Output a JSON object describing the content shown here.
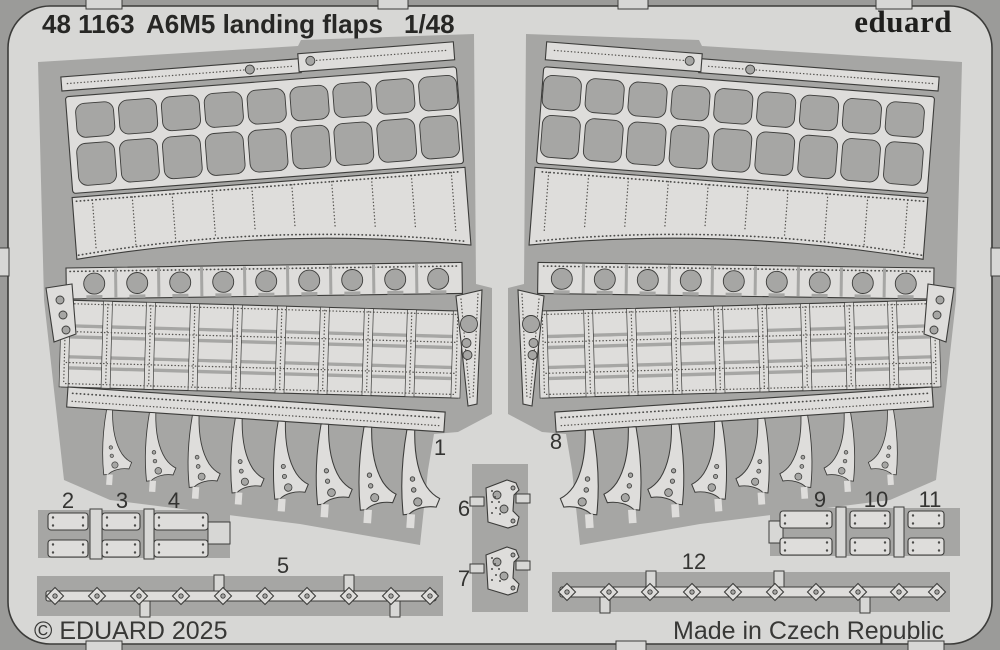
{
  "header": {
    "catalog_number": "48 1163",
    "title": "A6M5 landing flaps",
    "scale": "1/48",
    "brand": "eduard"
  },
  "footer": {
    "copyright": "© EDUARD 2025",
    "made_in": "Made in Czech Republic"
  },
  "part_labels": {
    "l1": "1",
    "l2": "2",
    "l3": "3",
    "l4": "4",
    "l5": "5",
    "l6": "6",
    "l7": "7",
    "l8": "8",
    "l9": "9",
    "l10": "10",
    "l11": "11",
    "l12": "12"
  },
  "colors": {
    "background": "#9b9b99",
    "fret_sheet": "#d7d7d5",
    "part_surface": "#dedddb",
    "cutout": "#a6a6a4",
    "outline": "#3c3c3a",
    "title_text": "#272725"
  }
}
